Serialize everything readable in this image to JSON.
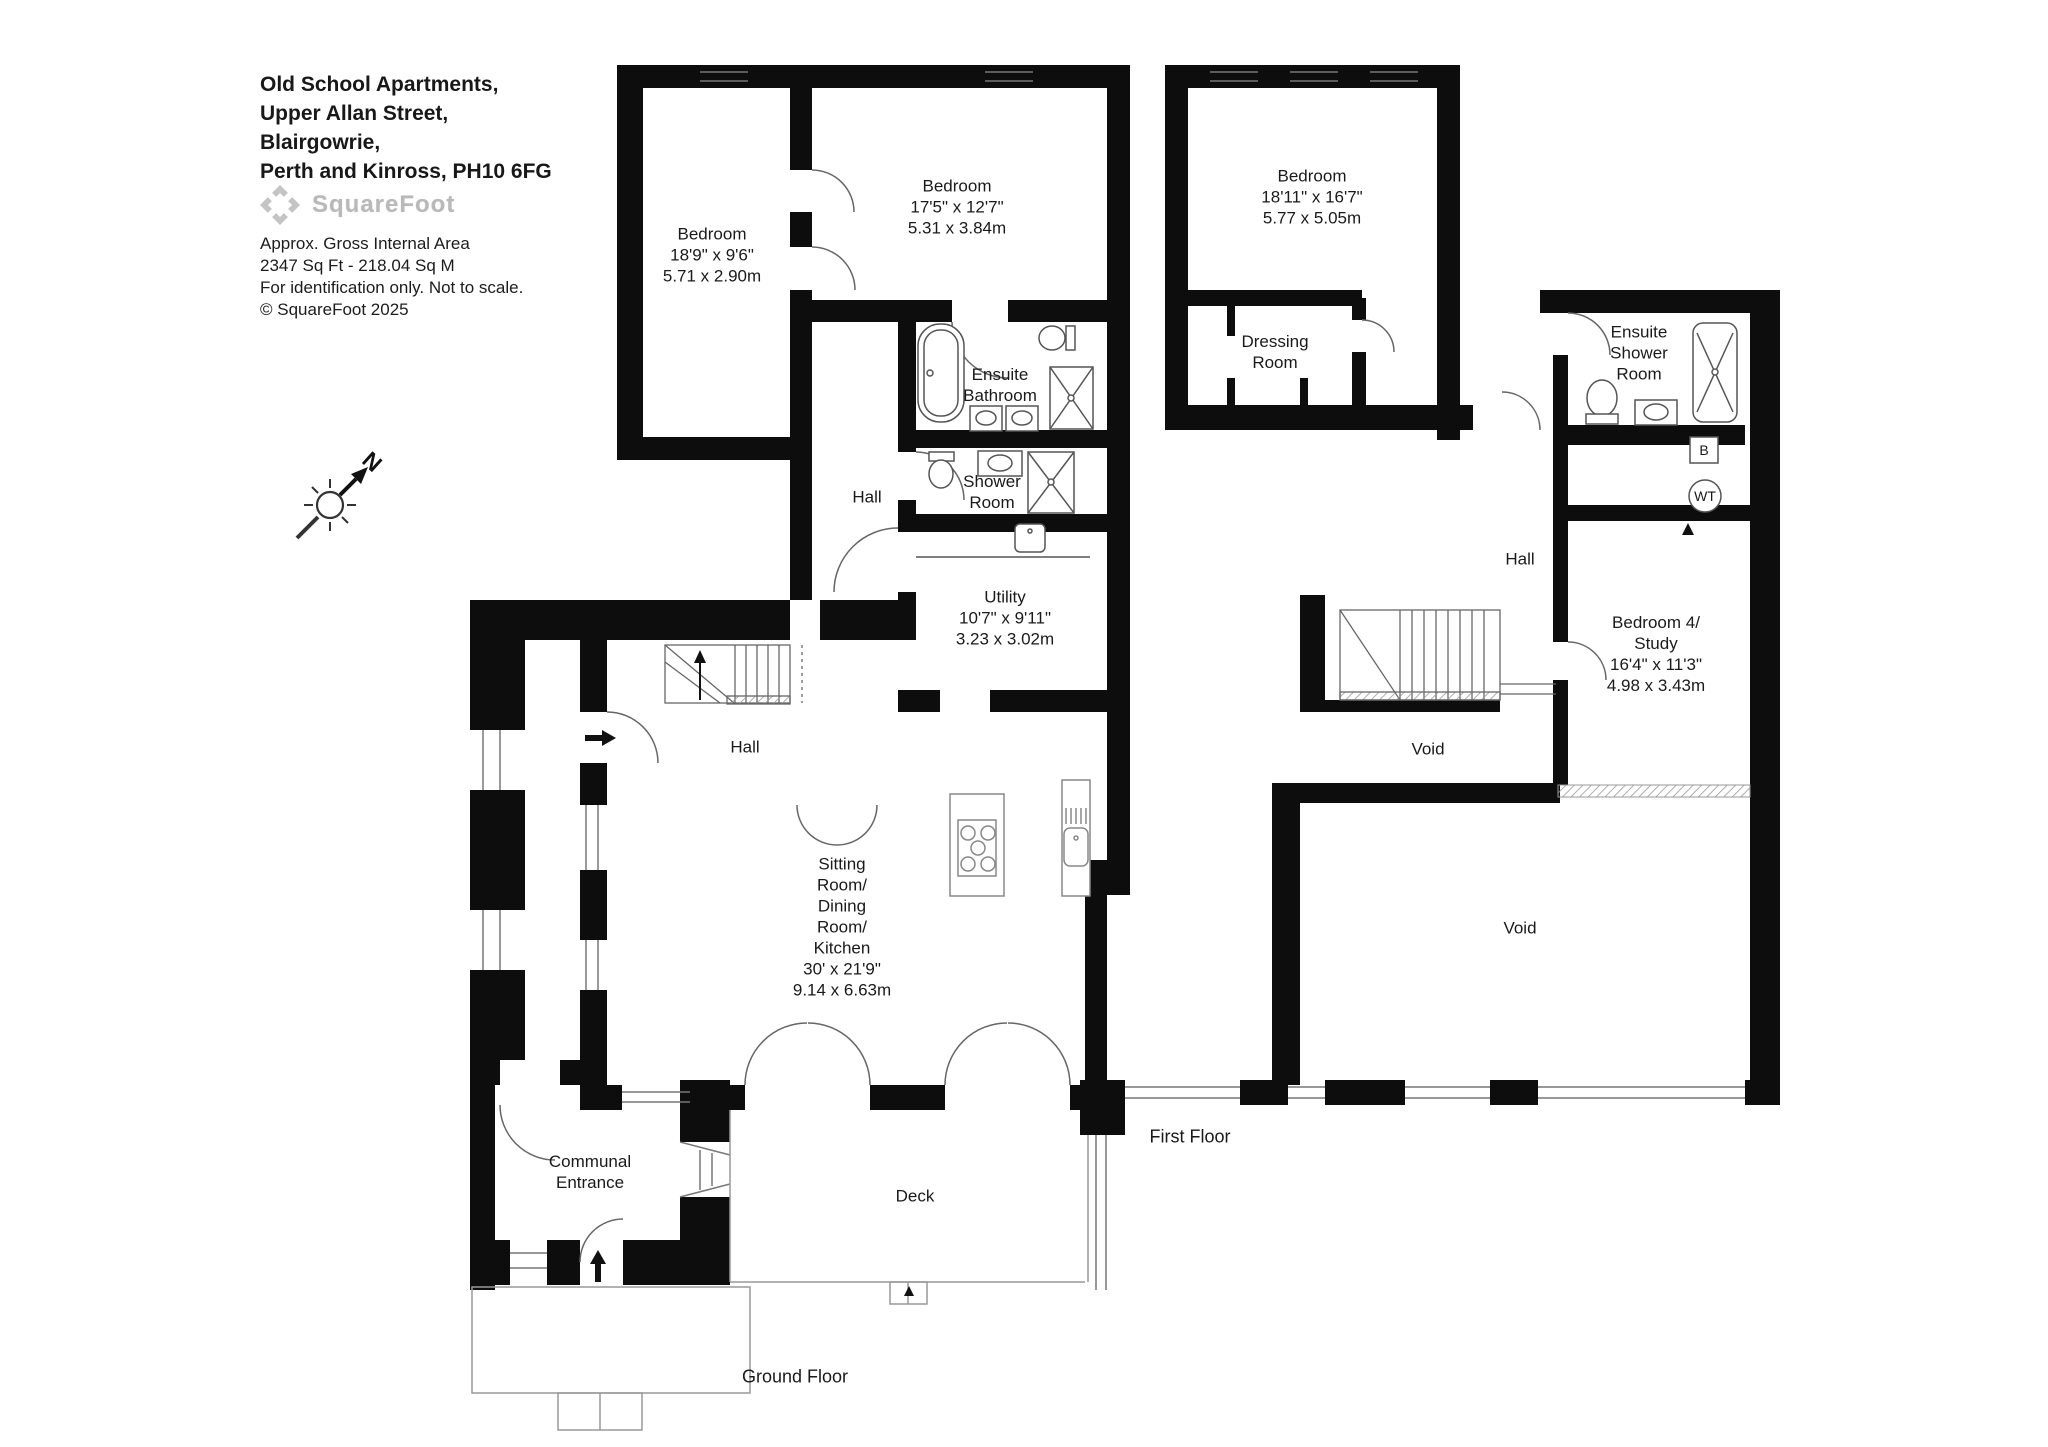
{
  "header": {
    "address_lines": [
      "Old School Apartments,",
      "Upper Allan Street,",
      "Blairgowrie,",
      "Perth and Kinross, PH10 6FG"
    ],
    "logo_text": "SquareFoot",
    "info_lines": [
      "Approx. Gross Internal Area",
      "2347 Sq Ft  -  218.04 Sq M",
      "For identification only. Not to scale.",
      "© SquareFoot 2025"
    ]
  },
  "compass": {
    "north_label": "N"
  },
  "ground": {
    "floor_label": "Ground Floor",
    "rooms": {
      "bedroom1": "Bedroom\n18'9\" x 9'6\"\n5.71 x 2.90m",
      "bedroom2": "Bedroom\n17'5\" x 12'7\"\n5.31 x 3.84m",
      "ensuite_bathroom": "Ensuite\nBathroom",
      "hall_upper": "Hall",
      "shower_room": "Shower\nRoom",
      "utility": "Utility\n10'7\" x 9'11\"\n3.23 x 3.02m",
      "hall_lower": "Hall",
      "sitting": "Sitting\nRoom/\nDining\nRoom/\nKitchen\n30' x 21'9\"\n9.14 x 6.63m",
      "communal_entrance": "Communal\nEntrance",
      "deck": "Deck"
    }
  },
  "first": {
    "floor_label": "First Floor",
    "rooms": {
      "bedroom": "Bedroom\n18'11\" x 16'7\"\n5.77 x 5.05m",
      "dressing_room": "Dressing\nRoom",
      "ensuite_shower_room": "Ensuite\nShower\nRoom",
      "hall": "Hall",
      "bedroom4": "Bedroom 4/\nStudy\n16'4\" x 11'3\"\n4.98 x 3.43m",
      "void1": "Void",
      "void2": "Void"
    },
    "annotations": {
      "boiler": "B",
      "water_tank": "WT"
    }
  }
}
